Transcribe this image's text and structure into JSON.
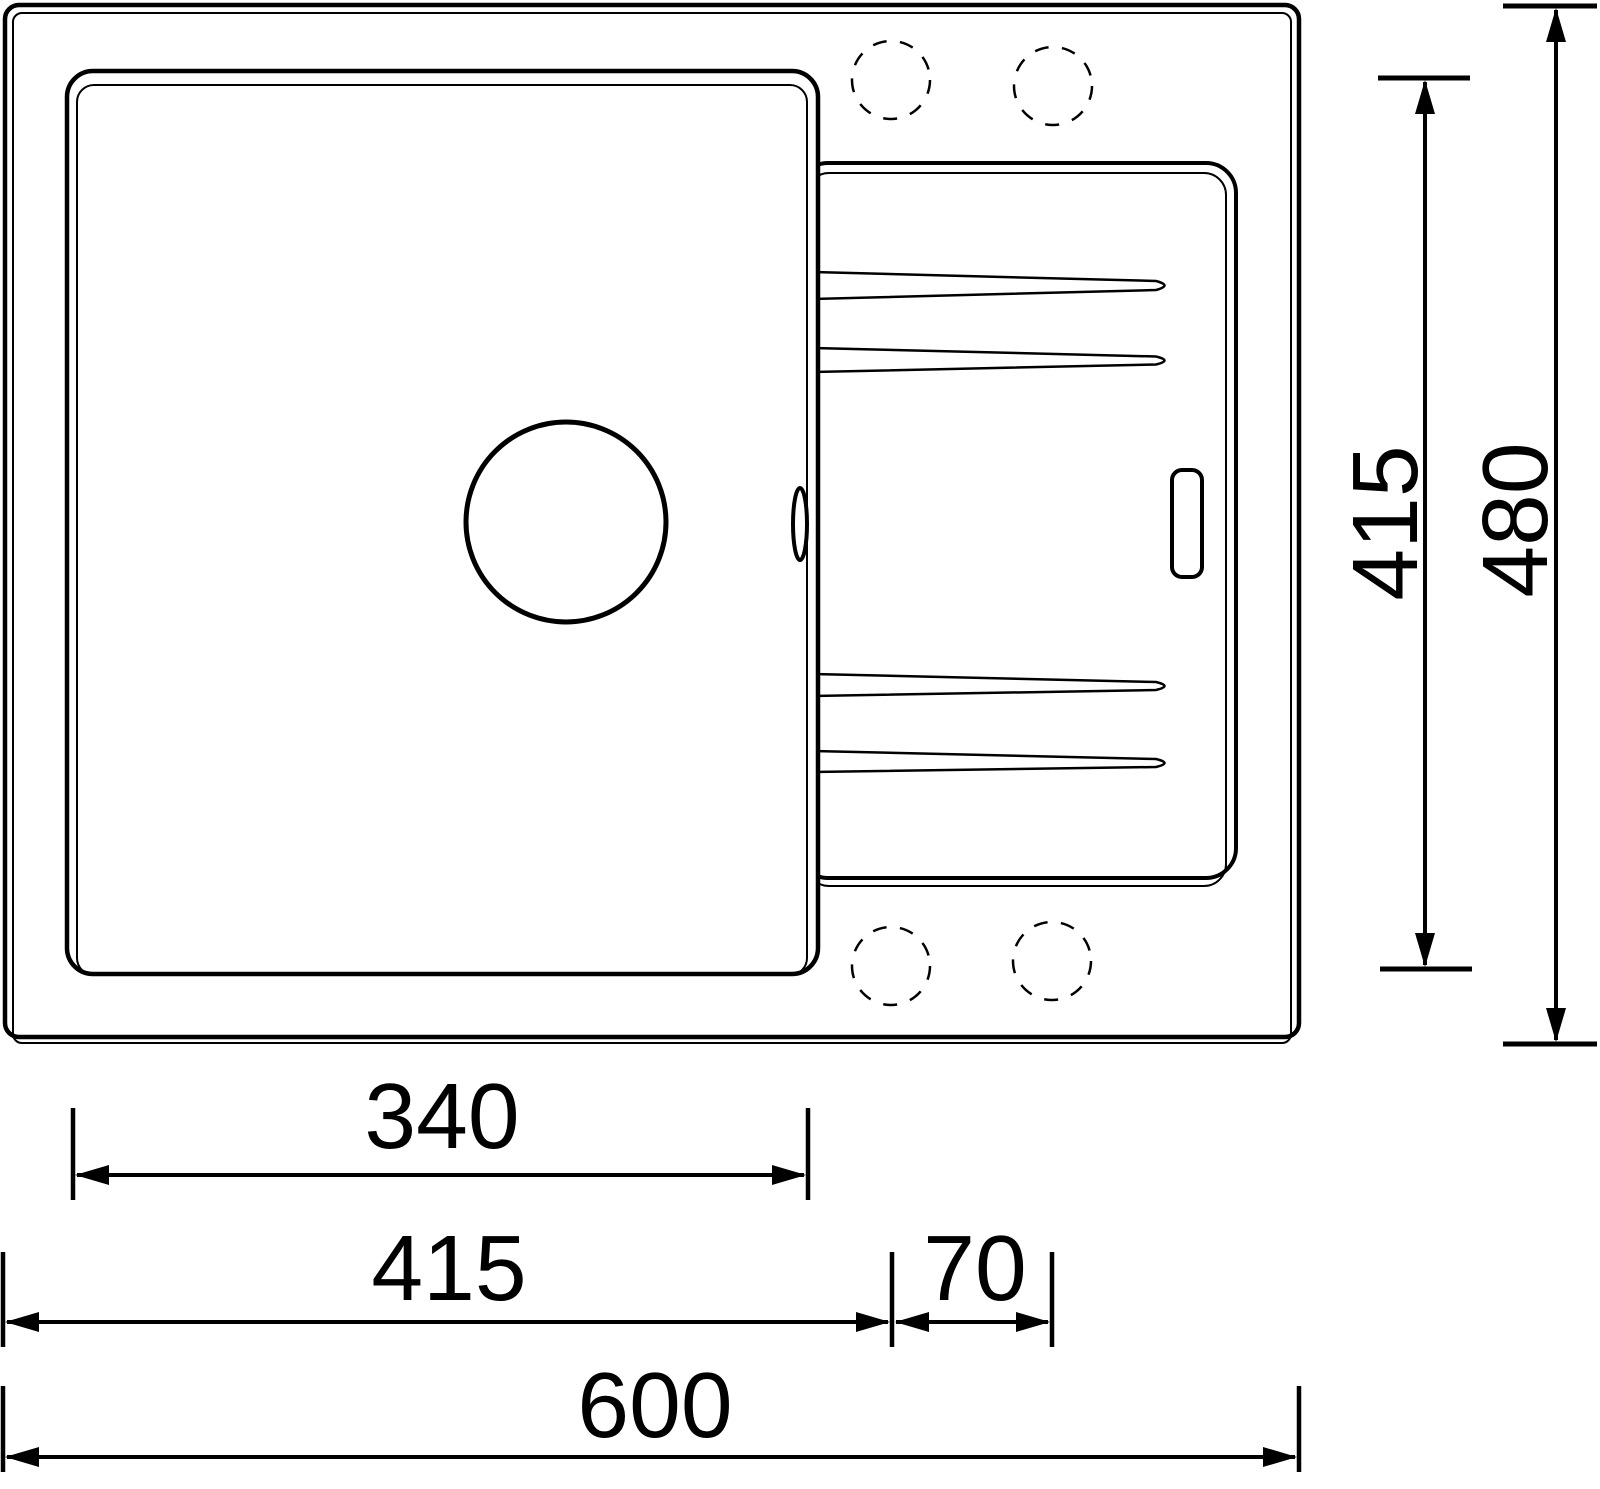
{
  "drawing": {
    "title": "sink-top-view-technical-drawing",
    "background_color": "#ffffff",
    "line_color": "#000000",
    "dimensions": {
      "basin_inner_width": {
        "label": "340",
        "orientation": "horizontal"
      },
      "left_edge_to_drainboard": {
        "label": "415",
        "orientation": "horizontal"
      },
      "drainboard_end_margin": {
        "label": "70",
        "orientation": "horizontal"
      },
      "overall_width": {
        "label": "600",
        "orientation": "horizontal"
      },
      "basin_inner_depth": {
        "label": "415",
        "orientation": "vertical"
      },
      "overall_depth": {
        "label": "480",
        "orientation": "vertical"
      }
    },
    "features": {
      "outer_body": "sink outer rim (double outline, rounded corners)",
      "basin": "main bowl (double outline, rounded corners)",
      "drain": "circular drain outlet in bowl",
      "overflow": "small oval overflow mark on bowl right edge",
      "drainboard": "ribbed draining board with four tapered grooves",
      "drainboard_slot": "small rounded slot on draining board",
      "faucet_holes": "four dashed pre-drilled tap hole positions"
    }
  }
}
